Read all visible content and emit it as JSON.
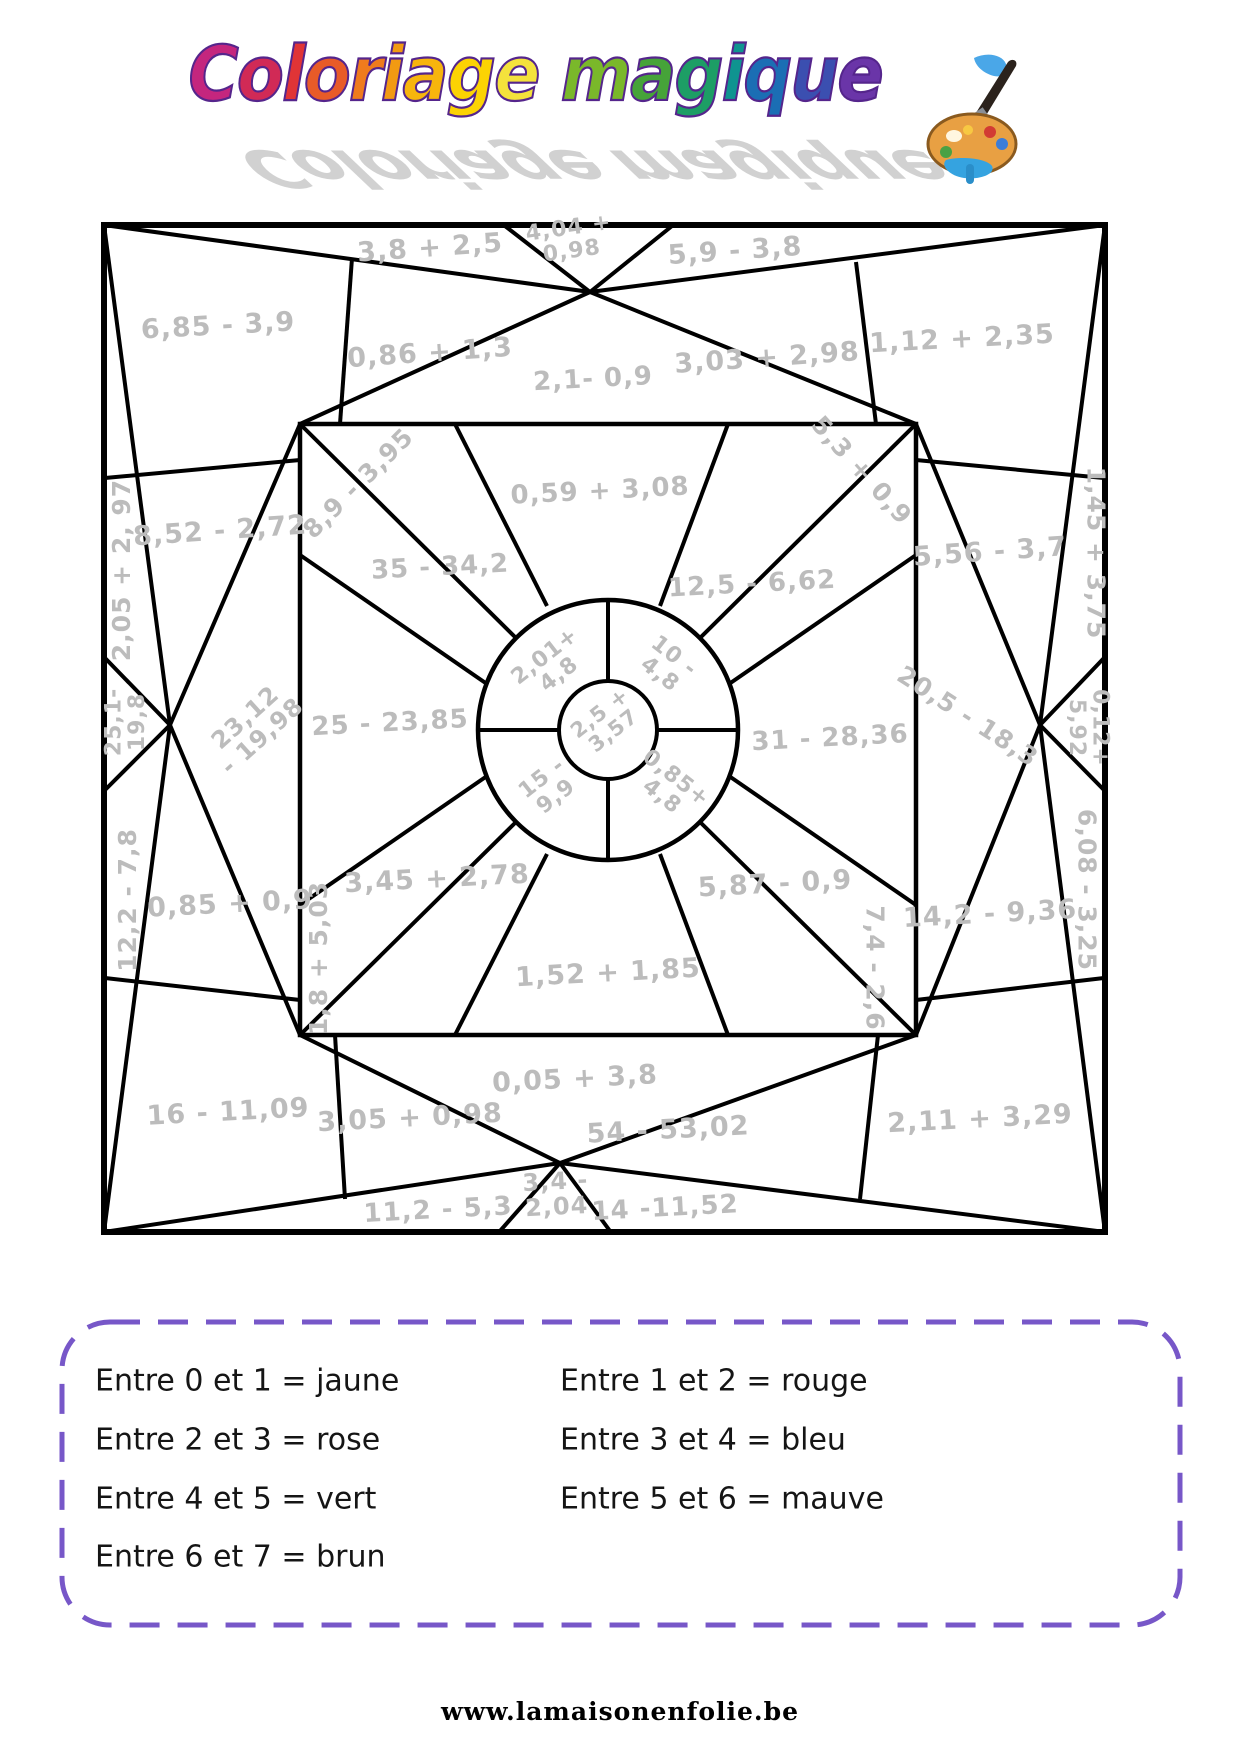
{
  "title": {
    "text": "Coloriage magique",
    "letter_colors": [
      "#c4267e",
      "#d12a56",
      "#e03436",
      "#e85b28",
      "#ef7b1d",
      "#f29a12",
      "#f7b50d",
      "#fcd303",
      "#f4e23c",
      "",
      "#7ab82a",
      "#46a339",
      "#1d9e65",
      "#0f9490",
      "#1b6eb4",
      "#3b4fb0",
      "#6a35a8"
    ],
    "outline_color": "#55258c",
    "shadow_color": "#c9c9c9",
    "icon": "paint-palette-icon"
  },
  "figure": {
    "stroke_color": "#000000",
    "label_color": "#bcbcbc",
    "labels": [
      {
        "text": "3,8 + 2,5",
        "x": 430,
        "y": 247,
        "r": -4,
        "s": 27
      },
      {
        "text": "4,04 +\n0,98",
        "x": 570,
        "y": 238,
        "r": -8,
        "s": 22
      },
      {
        "text": "5,9 - 3,8",
        "x": 735,
        "y": 250,
        "r": -4,
        "s": 27
      },
      {
        "text": "6,85 - 3,9",
        "x": 218,
        "y": 325,
        "r": -3,
        "s": 27
      },
      {
        "text": "0,86 + 1,3",
        "x": 430,
        "y": 352,
        "r": -4,
        "s": 27
      },
      {
        "text": "2,1- 0,9",
        "x": 593,
        "y": 378,
        "r": -3,
        "s": 26
      },
      {
        "text": "3,03 + 2,98",
        "x": 767,
        "y": 357,
        "r": -4,
        "s": 27
      },
      {
        "text": "1,12 + 2,35",
        "x": 962,
        "y": 338,
        "r": -3,
        "s": 27
      },
      {
        "text": "2,05 + 2, 97",
        "x": 121,
        "y": 570,
        "r": -90,
        "s": 25
      },
      {
        "text": "8,52 - 2,72",
        "x": 220,
        "y": 530,
        "r": -4,
        "s": 27
      },
      {
        "text": "25,1-\n19,8",
        "x": 124,
        "y": 722,
        "r": -90,
        "s": 22
      },
      {
        "text": "23,12\n- 19,98",
        "x": 253,
        "y": 726,
        "r": -42,
        "s": 24
      },
      {
        "text": "12,2 - 7,8",
        "x": 127,
        "y": 900,
        "r": -90,
        "s": 25
      },
      {
        "text": "0,85 + 0,9",
        "x": 230,
        "y": 903,
        "r": -3,
        "s": 27
      },
      {
        "text": "16 - 11,09",
        "x": 228,
        "y": 1111,
        "r": -3,
        "s": 27
      },
      {
        "text": "8,9 - 3,95",
        "x": 358,
        "y": 483,
        "r": -45,
        "s": 25
      },
      {
        "text": "0,59 + 3,08",
        "x": 600,
        "y": 490,
        "r": -3,
        "s": 26
      },
      {
        "text": "5,3 + 0,9",
        "x": 862,
        "y": 470,
        "r": 48,
        "s": 25
      },
      {
        "text": "35 - 34,2",
        "x": 440,
        "y": 566,
        "r": -3,
        "s": 26
      },
      {
        "text": "12,5 - 6,62",
        "x": 752,
        "y": 583,
        "r": -3,
        "s": 26
      },
      {
        "text": "25 - 23,85",
        "x": 390,
        "y": 722,
        "r": -3,
        "s": 26
      },
      {
        "text": "31 - 28,36",
        "x": 830,
        "y": 737,
        "r": -3,
        "s": 26
      },
      {
        "text": "2,01+\n4,8",
        "x": 551,
        "y": 664,
        "r": -38,
        "s": 22
      },
      {
        "text": "10 -\n4,8",
        "x": 668,
        "y": 664,
        "r": 38,
        "s": 22
      },
      {
        "text": "15 -\n9,9",
        "x": 548,
        "y": 786,
        "r": -38,
        "s": 22
      },
      {
        "text": "0,85+\n4,8",
        "x": 670,
        "y": 786,
        "r": 38,
        "s": 22
      },
      {
        "text": "2,5 +\n3,57",
        "x": 606,
        "y": 721,
        "r": -38,
        "s": 21
      },
      {
        "text": "3,45 + 2,78",
        "x": 437,
        "y": 878,
        "r": -3,
        "s": 27
      },
      {
        "text": "5,87 - 0,9",
        "x": 775,
        "y": 883,
        "r": -3,
        "s": 27
      },
      {
        "text": "1,8 + 5,03",
        "x": 318,
        "y": 958,
        "r": -90,
        "s": 25
      },
      {
        "text": "7,4 - 2,6",
        "x": 875,
        "y": 968,
        "r": 90,
        "s": 25
      },
      {
        "text": "1,52 + 1,85",
        "x": 608,
        "y": 972,
        "r": -3,
        "s": 27
      },
      {
        "text": "1,45 + 3,75",
        "x": 1096,
        "y": 553,
        "r": 90,
        "s": 25
      },
      {
        "text": "5,56 - 3,7",
        "x": 990,
        "y": 551,
        "r": -4,
        "s": 27
      },
      {
        "text": "20,5 - 18,3",
        "x": 968,
        "y": 716,
        "r": 33,
        "s": 25
      },
      {
        "text": "0,12+\n5,92",
        "x": 1090,
        "y": 728,
        "r": 90,
        "s": 22
      },
      {
        "text": "6,08 - 3,25",
        "x": 1087,
        "y": 890,
        "r": 90,
        "s": 25
      },
      {
        "text": "14,2 - 9,36",
        "x": 990,
        "y": 913,
        "r": -3,
        "s": 27
      },
      {
        "text": "2,11 + 3,29",
        "x": 980,
        "y": 1118,
        "r": -3,
        "s": 27
      },
      {
        "text": "3,05 + 0,98",
        "x": 410,
        "y": 1117,
        "r": -3,
        "s": 27
      },
      {
        "text": "0,05 + 3,8",
        "x": 575,
        "y": 1078,
        "r": -3,
        "s": 27
      },
      {
        "text": "54 - 53,02",
        "x": 668,
        "y": 1129,
        "r": -3,
        "s": 27
      },
      {
        "text": "11,2 - 5,3",
        "x": 438,
        "y": 1209,
        "r": -3,
        "s": 26
      },
      {
        "text": "3,4 -\n2,04",
        "x": 556,
        "y": 1193,
        "r": -3,
        "s": 24
      },
      {
        "text": "14 -11,52",
        "x": 665,
        "y": 1207,
        "r": -3,
        "s": 26
      }
    ]
  },
  "legend": {
    "border_color": "#7757c8",
    "items": [
      {
        "text": "Entre 0 et 1 = jaune"
      },
      {
        "text": "Entre 1 et 2 = rouge"
      },
      {
        "text": "Entre 2 et 3 = rose"
      },
      {
        "text": "Entre 3 et 4 = bleu"
      },
      {
        "text": "Entre 4 et 5 = vert"
      },
      {
        "text": "Entre 5 et 6 = mauve"
      },
      {
        "text": "Entre 6 et 7 = brun"
      }
    ]
  },
  "footer": {
    "url": "www.lamaisonenfolie.be"
  }
}
